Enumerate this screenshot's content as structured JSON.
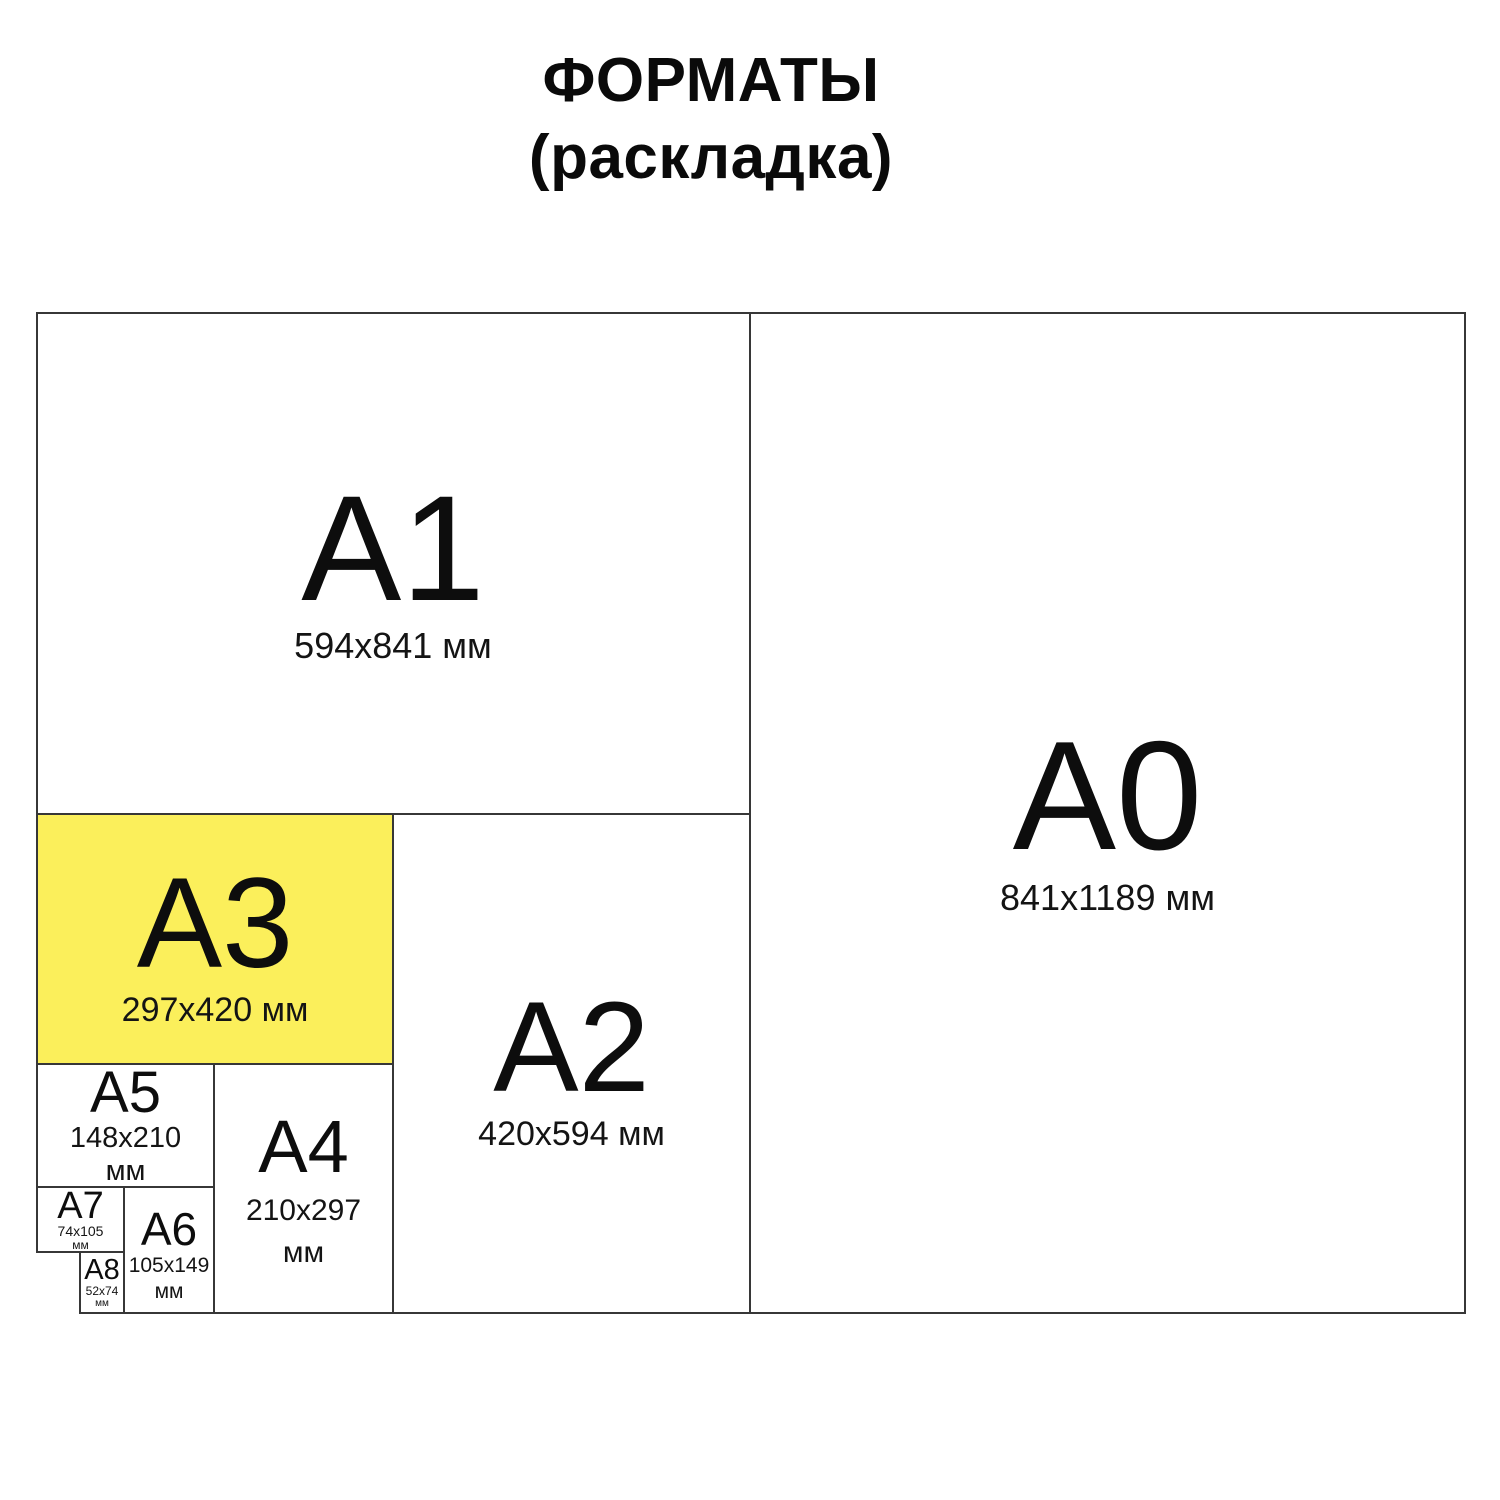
{
  "title": {
    "line1": "ФОРМАТЫ",
    "line2": "(раскладка)"
  },
  "colors": {
    "background": "#FFFFFF",
    "highlight": "#FBEF5B",
    "line": "#373737",
    "text": "#111111"
  },
  "formats": {
    "a0": {
      "label": "A0",
      "size": "841x1189 мм",
      "highlighted": false
    },
    "a1": {
      "label": "A1",
      "size": "594x841 мм",
      "highlighted": false
    },
    "a2": {
      "label": "A2",
      "size": "420x594 мм",
      "highlighted": false
    },
    "a3": {
      "label": "A3",
      "size": "297x420 мм",
      "highlighted": true
    },
    "a4": {
      "label": "A4",
      "size_line1": "210x297",
      "size_line2": "мм",
      "highlighted": false
    },
    "a5": {
      "label": "A5",
      "size_line1": "148x210",
      "size_line2": "мм",
      "highlighted": false
    },
    "a6": {
      "label": "A6",
      "size_line1": "105x149",
      "size_line2": "мм",
      "highlighted": false
    },
    "a7": {
      "label": "A7",
      "size_line1": "74x105",
      "size_line2": "мм",
      "highlighted": false
    },
    "a8": {
      "label": "A8",
      "size_line1": "52x74",
      "size_line2": "мм",
      "highlighted": false
    }
  }
}
